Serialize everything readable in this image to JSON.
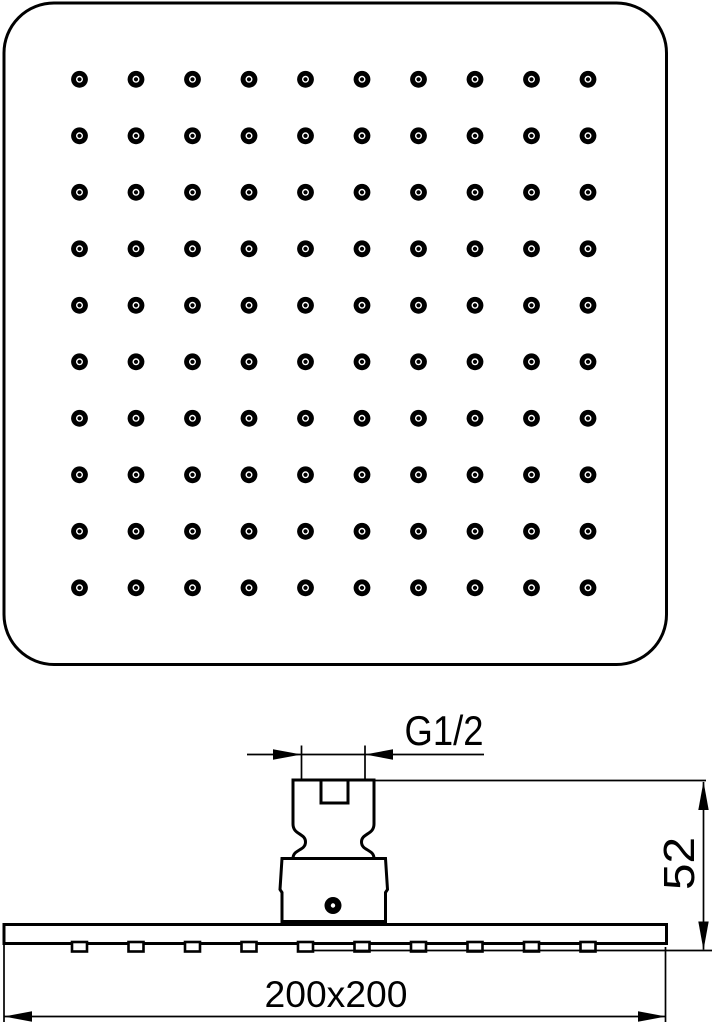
{
  "drawing": {
    "background_color": "#ffffff",
    "line_color": "#000000",
    "top_view": {
      "nozzle_grid": {
        "rows": 10,
        "cols": 10
      }
    },
    "side_view": {
      "nozzle_stub_count": 10
    },
    "dimensions": {
      "thread": {
        "label": "G1/2"
      },
      "height": {
        "label": "52"
      },
      "footprint": {
        "label": "200x200"
      }
    }
  }
}
